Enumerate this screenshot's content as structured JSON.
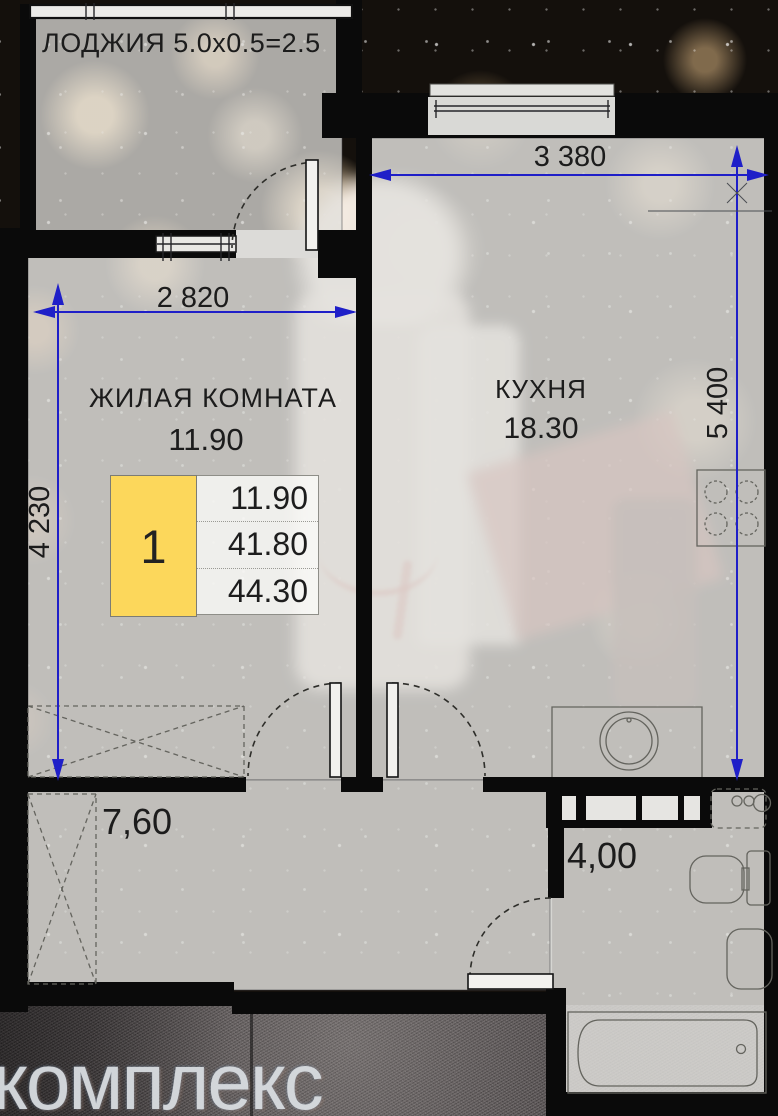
{
  "rooms": {
    "loggia": {
      "label": "ЛОДЖИЯ 5.0x0.5=2.5"
    },
    "living_room": {
      "name": "ЖИЛАЯ КОМНАТА",
      "area": "11.90"
    },
    "kitchen": {
      "name": "КУХНЯ",
      "area": "18.30"
    },
    "hallway": {
      "area": "7,60"
    },
    "bathroom": {
      "area": "4,00"
    }
  },
  "legend": {
    "unit_number": "1",
    "living_area": "11.90",
    "area_without_loggia": "41.80",
    "total_area": "44.30"
  },
  "dimensions": {
    "living_room_width": "2 820",
    "living_room_depth": "4 230",
    "kitchen_width": "3 380",
    "kitchen_depth": "5 400"
  },
  "watermark": {
    "text": "комплекс"
  },
  "colors": {
    "dimension_accent": "#1f1fc8",
    "legend_highlight": "#fcd75b",
    "wall": "#0a0a0a"
  }
}
